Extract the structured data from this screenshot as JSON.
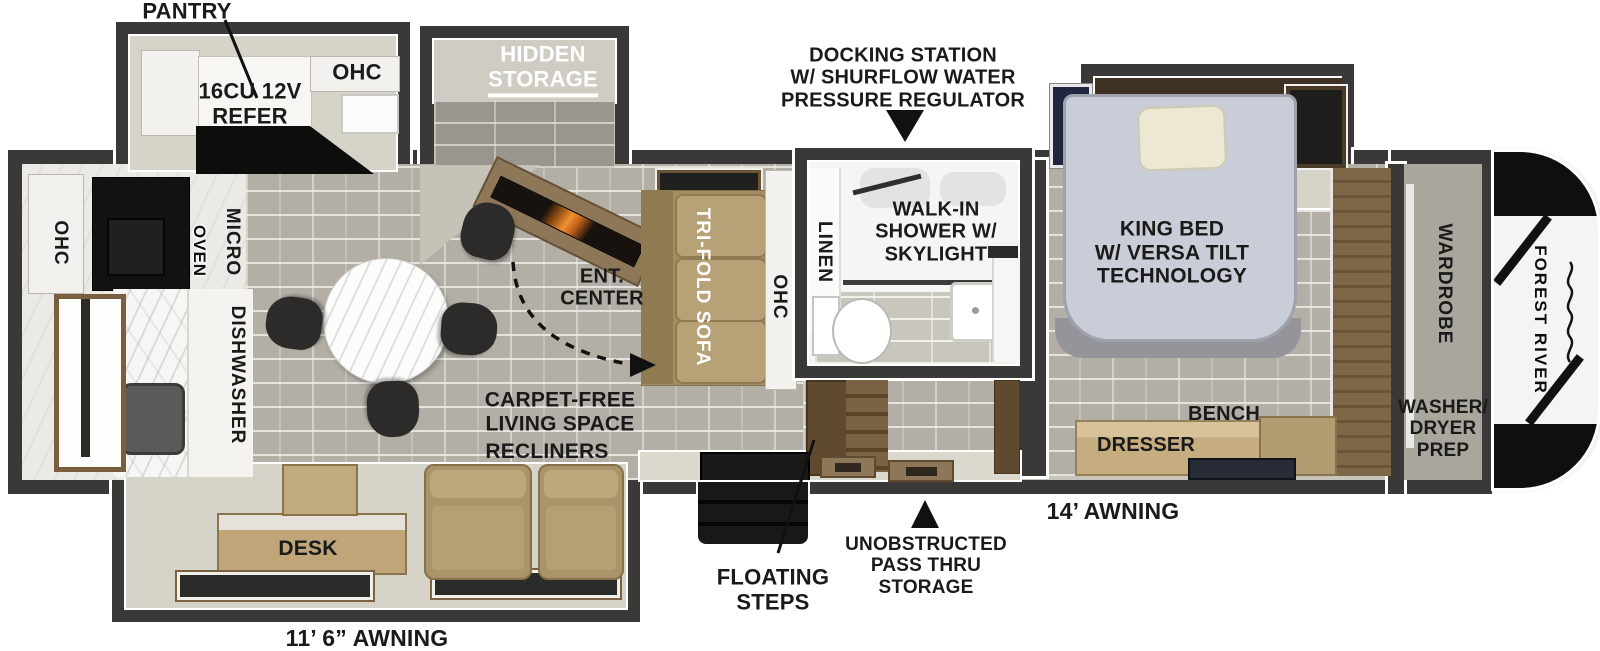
{
  "floorplan": {
    "brand": "FOREST RIVER",
    "awnings": {
      "left": "11’ 6” AWNING",
      "right": "14’ AWNING"
    },
    "callouts": {
      "pantry": "PANTRY",
      "docking": "DOCKING STATION\nW/ SHURFLOW WATER\nPRESSURE REGULATOR",
      "floating_steps": "FLOATING\nSTEPS",
      "pass_thru": "UNOBSTRUCTED\nPASS THRU\nSTORAGE"
    },
    "kitchen": {
      "refer": "16CU 12V\nREFER",
      "ohc_top": "OHC",
      "ohc_left": "OHC",
      "oven": "OVEN",
      "micro": "MICRO",
      "dishwasher": "DISHWASHER",
      "hidden_storage": "HIDDEN\nSTORAGE"
    },
    "living": {
      "ent_center": "ENT.\nCENTER",
      "sofa": "TRI-FOLD SOFA",
      "sofa_ohc": "OHC",
      "carpet_free": "CARPET-FREE\nLIVING SPACE",
      "recliners": "RECLINERS",
      "desk": "DESK"
    },
    "bath": {
      "linen": "LINEN",
      "shower": "WALK-IN\nSHOWER W/\nSKYLIGHT"
    },
    "bedroom": {
      "king_bed": "KING BED\nW/ VERSA TILT\nTECHNOLOGY",
      "bench": "BENCH",
      "dresser": "DRESSER",
      "wardrobe": "WARDROBE",
      "washer_dryer": "WASHER/\nDRYER\nPREP"
    },
    "colors": {
      "wall": "#3a3937",
      "floor_tile": "#b3afa7",
      "slide_floor": "#d6d3c9",
      "wood": "#8d7758",
      "sofa_tan": "#b7a176",
      "bed": "#c9cdd7",
      "fire_accent": "#f09030"
    }
  }
}
